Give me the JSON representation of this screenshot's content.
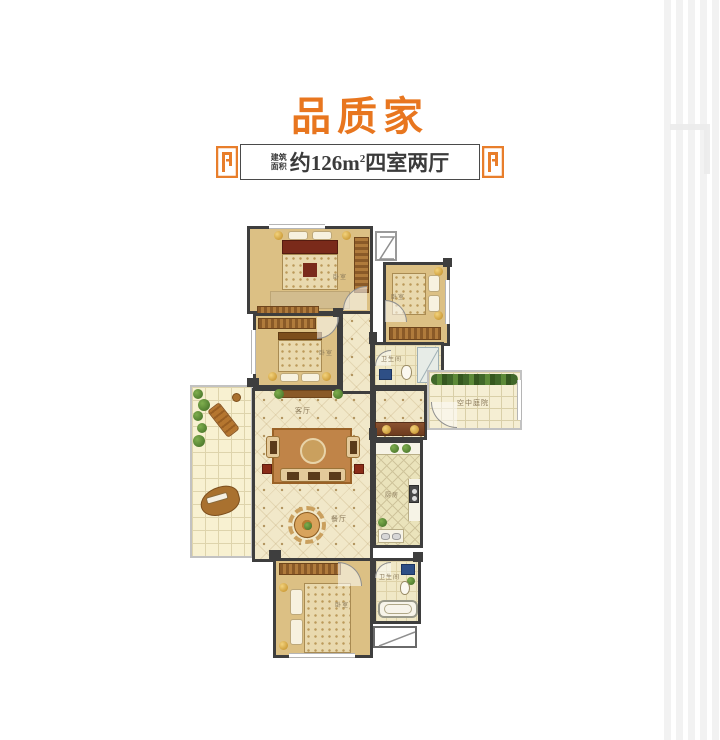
{
  "title": {
    "text": "品质家"
  },
  "banner": {
    "label_line1": "建筑",
    "label_line2": "面积",
    "area_main": "约126m",
    "area_sup": "2",
    "area_suffix": "四室两厅"
  },
  "labels": [
    {
      "room": "bedroom-top-left",
      "text": "卧室"
    },
    {
      "room": "bedroom-top-right",
      "text": "卧室"
    },
    {
      "room": "bedroom-middle-left",
      "text": "卧室"
    },
    {
      "room": "bathroom-middle",
      "text": "卫生间"
    },
    {
      "room": "sky-courtyard",
      "text": "空中庭院"
    },
    {
      "room": "living-room",
      "text": "客厅"
    },
    {
      "room": "kitchen",
      "text": "厨房"
    },
    {
      "room": "dining-area",
      "text": "餐厅"
    },
    {
      "room": "bathroom-bottom",
      "text": "卫生间"
    },
    {
      "room": "bedroom-bottom",
      "text": "卧室"
    }
  ],
  "colors": {
    "accent_orange": "#e8761f",
    "banner_text": "#3b3b3b",
    "wall": "#3e3e3e",
    "wood_floor": "#dcc084",
    "tile_floor": "#f1e8c9",
    "terrace_floor": "#f8f1d1",
    "kitchen_floor": "#eae3bb",
    "bath_floor": "#f0e8c6",
    "courtyard_floor": "#f5eed3",
    "plant_green": "#4c7a2d",
    "furniture_brown": "#9c6527"
  }
}
